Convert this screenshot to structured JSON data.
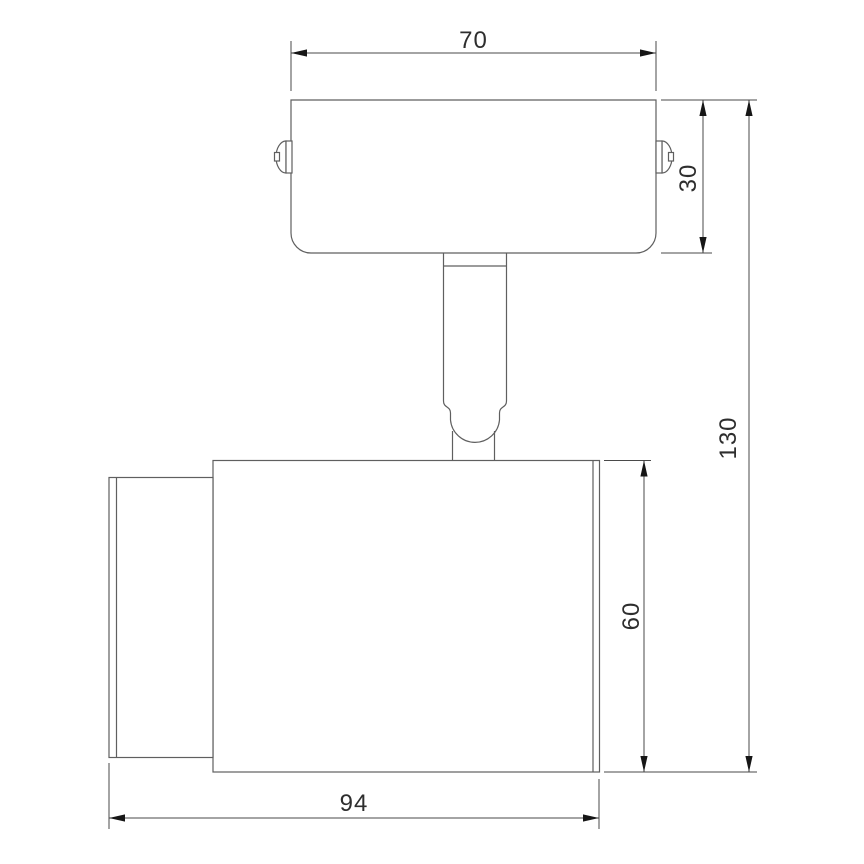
{
  "dimensions": {
    "bracket_width": "70",
    "bracket_height": "30",
    "overall_height": "130",
    "head_height": "60",
    "head_length": "94"
  },
  "colors": {
    "background": "#ffffff",
    "outline": "#5f5f5f",
    "dimension_line": "#4a4a4a",
    "arrow": "#161616",
    "text": "#2e2e2e"
  }
}
